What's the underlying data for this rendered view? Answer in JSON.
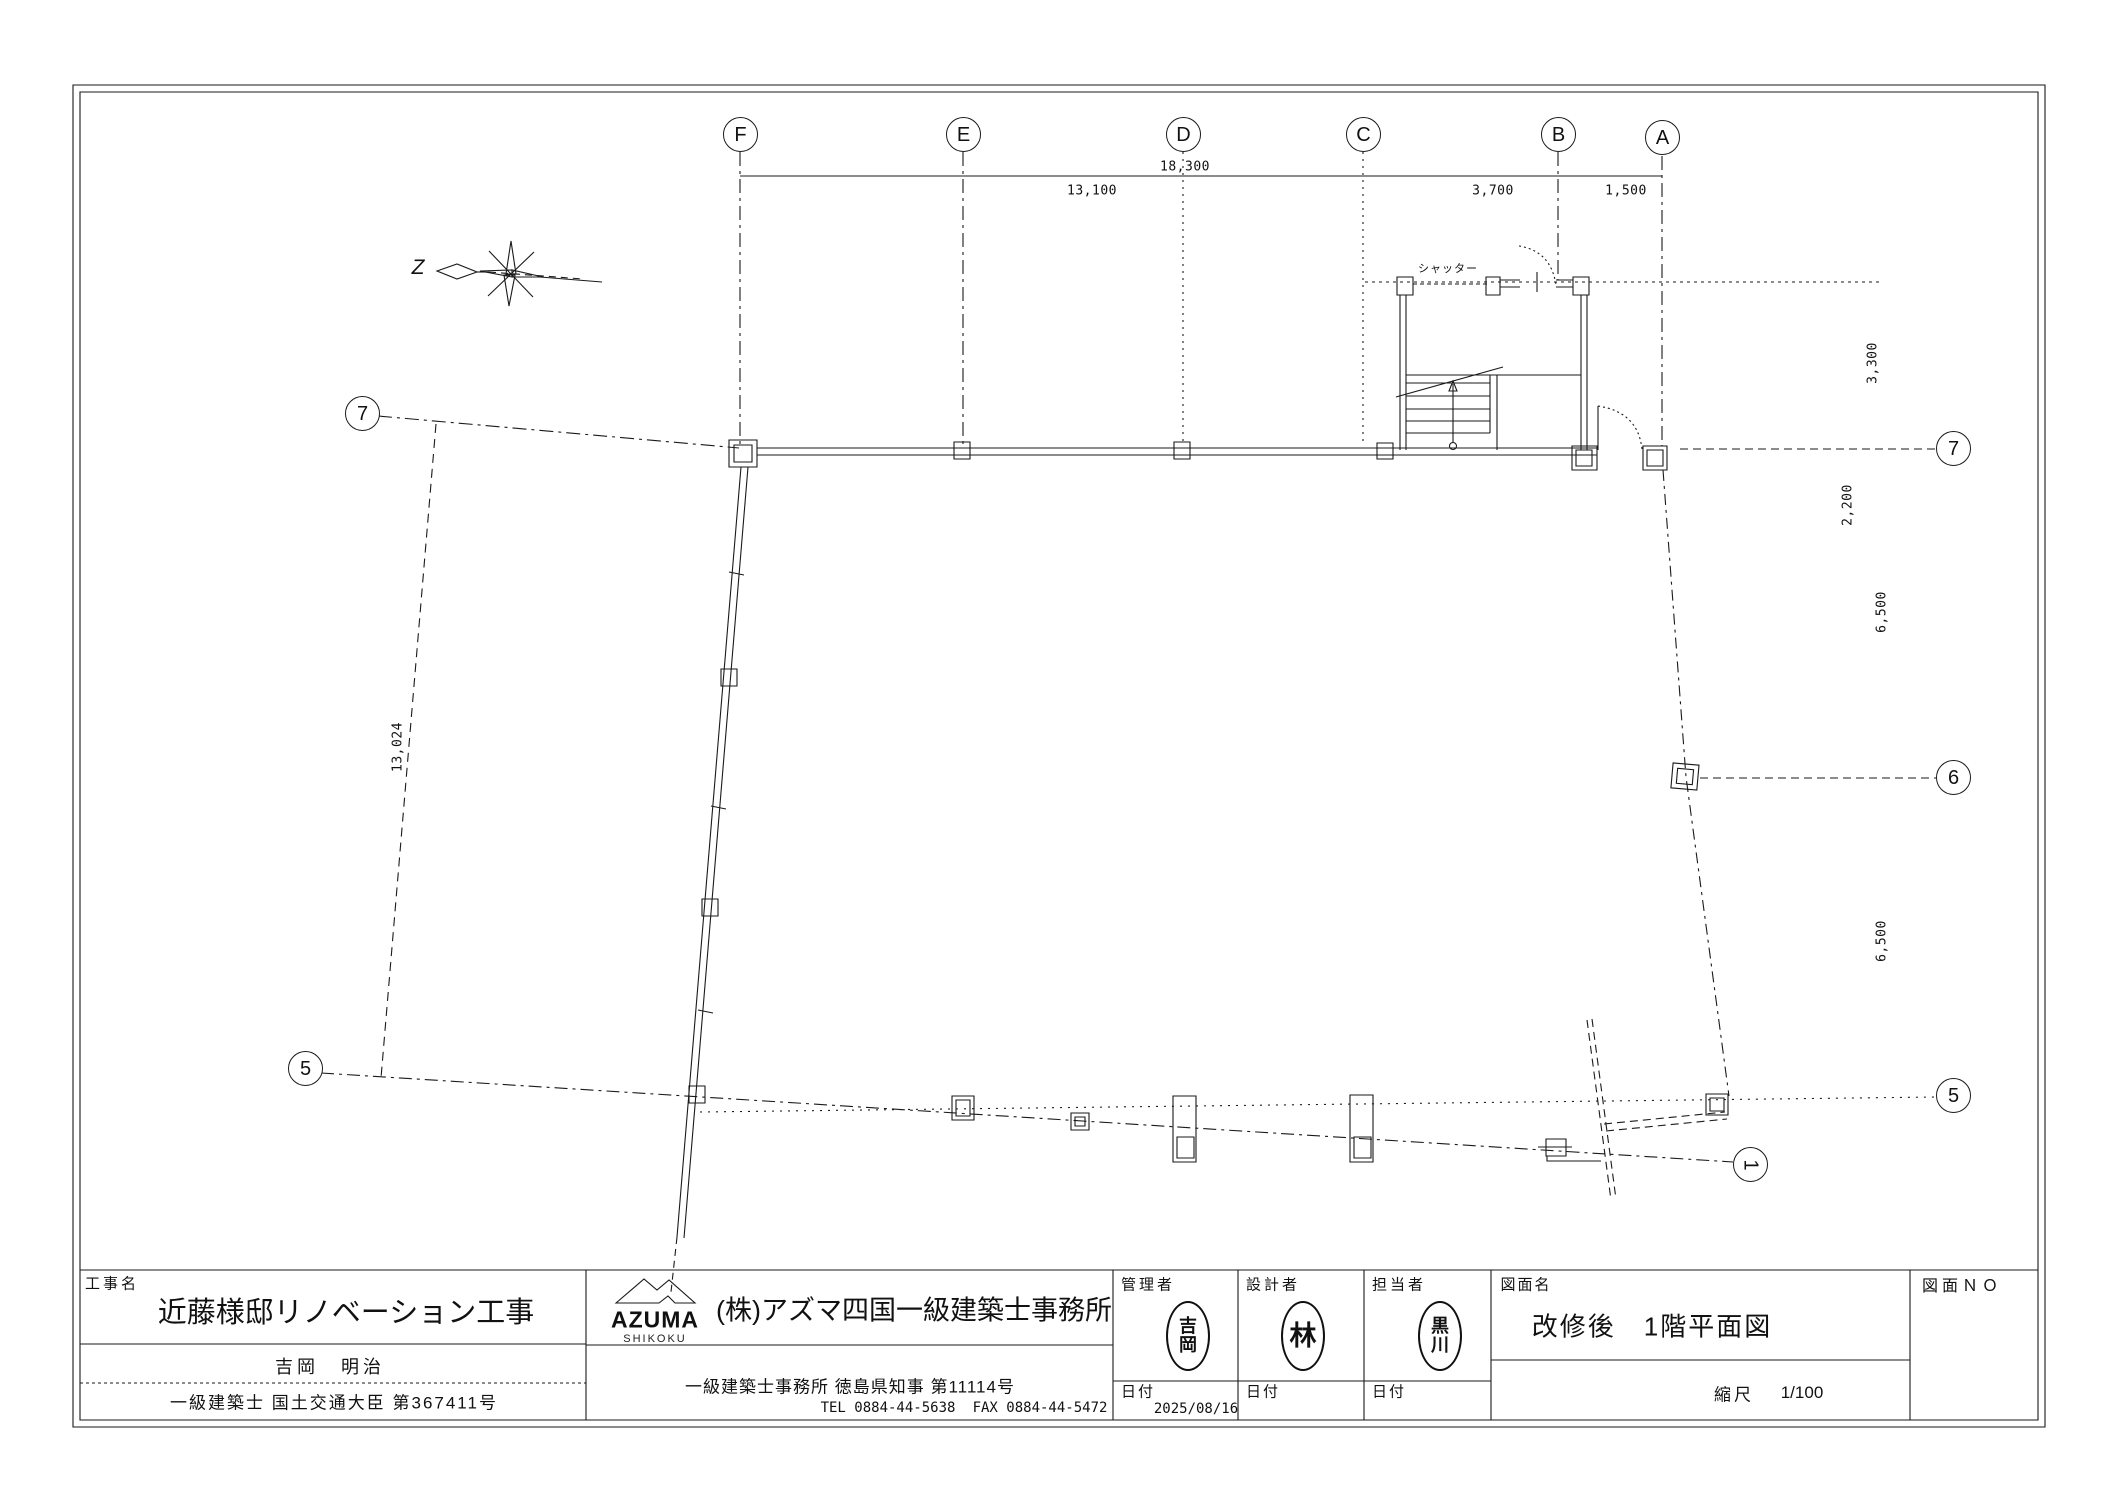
{
  "grid": {
    "top_labels": [
      "F",
      "E",
      "D",
      "C",
      "B",
      "A"
    ],
    "left_labels": [
      "7",
      "5"
    ],
    "right_labels": [
      "7",
      "6",
      "5"
    ],
    "bottom_label": "1"
  },
  "dimensions": {
    "top_total": "18,300",
    "top_seg_1": "13,100",
    "top_seg_2": "3,700",
    "top_seg_3": "1,500",
    "right_1": "3,300",
    "right_2": "2,200",
    "right_3": "6,500",
    "right_4": "6,500",
    "left_boundary": "13,024"
  },
  "annotations": {
    "shutter": "シャッター",
    "north_label": "Z"
  },
  "title_block": {
    "project_label": "工事名",
    "project_name": "近藤様邸リノベーション工事",
    "client_name": "吉岡　明治",
    "architect_license": "一級建築士 国土交通大臣 第367411号",
    "logo_text": "AZUMA",
    "logo_sub": "SHIKOKU",
    "company_name": "(株)アズマ四国一級建築士事務所",
    "office_license": "一級建築士事務所 徳島県知事 第11114号",
    "tel": "TEL 0884-44-5638",
    "fax": "FAX 0884-44-5472",
    "manager_label": "管理者",
    "designer_label": "設計者",
    "staff_label": "担当者",
    "date_label_1": "日付",
    "date_label_2": "日付",
    "date_label_3": "日付",
    "date_value": "2025/08/16",
    "stamp_manager_top": "吉",
    "stamp_manager_bottom": "岡",
    "stamp_designer": "林",
    "stamp_staff_top": "黒",
    "stamp_staff_bottom": "川",
    "drawing_name_label": "図面名",
    "drawing_name": "改修後　1階平面図",
    "scale_label": "縮尺",
    "scale_value": "1/100",
    "drawing_no_label": "図面ＮＯ"
  }
}
